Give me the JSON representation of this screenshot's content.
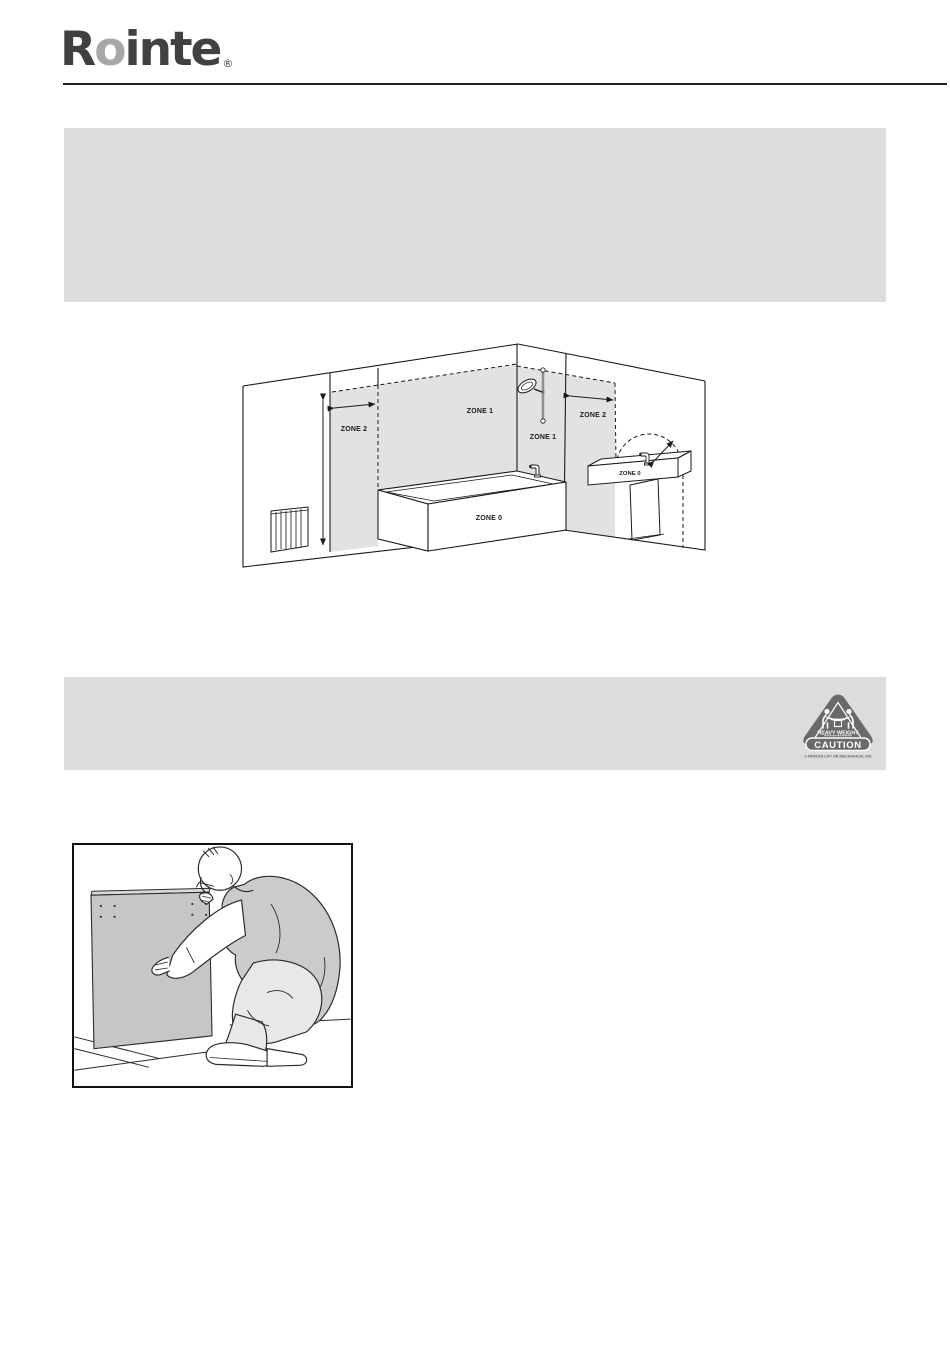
{
  "page": {
    "background": "#ffffff"
  },
  "header": {
    "logo_r": "R",
    "logo_o": "o",
    "logo_rest": "inte",
    "registered_mark": "®",
    "logo_dark_color": "#414042",
    "logo_gray_color": "#a7a7aa"
  },
  "blocks": {
    "text_block_1": "",
    "text_block_2": ""
  },
  "zones_diagram": {
    "labels": {
      "zone2_left": "ZONE 2",
      "zone1_wall": "ZONE 1",
      "zone1_shower": "ZONE 1",
      "zone2_right": "ZONE 2",
      "zone0_bath": "ZONE 0",
      "zone0_basin": "ZONE 0"
    },
    "shade_color": "#e2e2e2",
    "line_color": "#1a1a1a"
  },
  "caution_badge": {
    "heading": "HEAVY WEIGHT",
    "title": "CAUTION",
    "subtitle": "2 PERSON LIFT OR MECHANICAL AID",
    "color": "#6a6a6a"
  },
  "icons": {
    "caution_triangle": "heavy-weight-two-person-lift-triangle"
  }
}
